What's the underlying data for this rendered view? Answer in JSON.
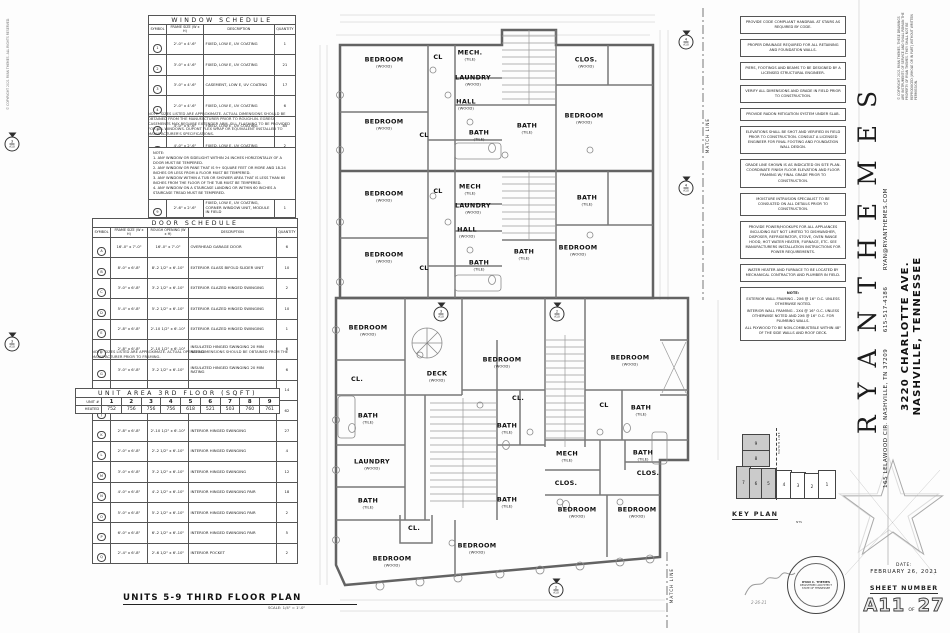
{
  "page": {
    "plan_title": "UNITS 5-9 THIRD FLOOR PLAN",
    "plan_scale": "SCALE: 1/4\" = 1'-0\"",
    "margin_note": "© COPYRIGHT 2021 RYAN THEMES. ALL RIGHTS RESERVED."
  },
  "window_schedule": {
    "title": "WINDOW SCHEDULE",
    "headers": [
      "SYMBOL",
      "FRAME SIZE (W x H)",
      "DESCRIPTION",
      "QUANTITY"
    ],
    "rows": [
      {
        "sym": "1",
        "size": "2'-0\" x 4'-6\"",
        "desc": "FIXED, LOW E, UV COATING",
        "qty": "1"
      },
      {
        "sym": "2",
        "size": "3'-0\" x 4'-6\"",
        "desc": "FIXED, LOW E, UV COATING",
        "qty": "21"
      },
      {
        "sym": "3",
        "size": "3'-0\" x 4'-6\"",
        "desc": "CASEMENT, LOW E, UV COATING",
        "qty": "17"
      },
      {
        "sym": "4",
        "size": "2'-0\" x 4'-6\"",
        "desc": "FIXED, LOW E, UV COATING",
        "qty": "6"
      },
      {
        "sym": "5",
        "size": "4'-0\" x 4'-6\"",
        "desc": "FIXED, LOW E, UV COATING",
        "qty": "85"
      },
      {
        "sym": "6",
        "size": "4'-0\" x 2'-6\"",
        "desc": "FIXED, LOW E, UV COATING",
        "qty": "2"
      },
      {
        "sym": "7",
        "size": "2'-0\" x 2'-0\"",
        "desc": "FIXED, LOW E, UV COATING",
        "qty": "7"
      },
      {
        "sym": "8",
        "size": "2'-6\" x 4'-6\"",
        "desc": "FIXED, LOW E, UV COATING",
        "qty": "2"
      },
      {
        "sym": "9",
        "size": "2'-6\" x 2'-6\"",
        "desc": "FIXED, LOW E, UV COATING, CORNER WINDOW UNIT, MODULE IN FIELD",
        "qty": "1"
      },
      {
        "sym": "10",
        "size": "2'-6\" x 2'-6\"",
        "desc": "FIXED, LOW E, UV COATING, CORNER WINDOW UNIT, MODULE IN FIELD",
        "qty": "2"
      }
    ],
    "note": "NOTE: SIZES LISTED ARE APPROXIMATE. ACTUAL DIMENSIONS SHOULD BE OBTAINED FROM THE MANUFACTURER PRIOR TO ROUGH-IN. EGRESS CASEMENTS MAY REQUIRE EXTENDER ARM. SILL FLASHING TO BE PROVIDED FOR ALL WINDOWS. DUPONT FLEX WRAP OR EQUIVALENT INSTALLED TO MANUFACTURER'S SPECIFICATIONS."
  },
  "tempered_notes": {
    "title": "NOTE:",
    "items": [
      "1. ANY WINDOW OR SIDELIGHT WITHIN 24 INCHES HORIZONTALLY OF A DOOR MUST BE TEMPERED.",
      "2. ANY WINDOW OR PANE THAT IS 9+ SQUARE FEET OR MORE AND 18-24 INCHES OR LESS FROM A FLOOR MUST BE TEMPERED.",
      "3. ANY WINDOW WITHIN A TUB OR SHOWER AREA THAT IS LESS THAN 60 INCHES FROM THE FLOOR OF THE TUB MUST BE TEMPERED.",
      "4. ANY WINDOW ON A STAIRCASE LANDING OR WITHIN 60 INCHES A STAIRCASE TREAD MUST BE TEMPERED."
    ]
  },
  "door_schedule": {
    "title": "DOOR SCHEDULE",
    "headers": [
      "SYMBOL",
      "FRAME SIZE (W x H)",
      "ROUGH OPENING (W x H)",
      "DESCRIPTION",
      "QUANTITY"
    ],
    "rows": [
      {
        "sym": "A",
        "frame": "16'-0\" x 7'-0\"",
        "rough": "16'-0\" x 7'-0\"",
        "desc": "OVERHEAD GARAGE DOOR",
        "qty": "6"
      },
      {
        "sym": "B",
        "frame": "8'-0\" x 6'-8\"",
        "rough": "8'-2 1/2\" x 6'-10\"",
        "desc": "EXTERIOR GLASS BIFOLD SLIDER UNIT",
        "qty": "10"
      },
      {
        "sym": "C",
        "frame": "3'-0\" x 6'-8\"",
        "rough": "3'-2 1/2\" x 6'-10\"",
        "desc": "EXTERIOR GLAZED HINGED SWINGING",
        "qty": "2"
      },
      {
        "sym": "D",
        "frame": "5'-4\" x 6'-8\"",
        "rough": "5'-2 1/2\" x 6'-10\"",
        "desc": "EXTERIOR GLAZED HINGED SWINGING",
        "qty": "10"
      },
      {
        "sym": "E",
        "frame": "2'-8\" x 6'-8\"",
        "rough": "2'-10 1/2\" x 6'-10\"",
        "desc": "EXTERIOR GLAZED HINGED SWINGING",
        "qty": "1"
      },
      {
        "sym": "F",
        "frame": "2'-8\" x 6'-8\"",
        "rough": "2'-10 1/2\" x 6'-10\"",
        "desc": "INSULATED HINGED SWINGING 20 MIN RATING",
        "qty": "6"
      },
      {
        "sym": "G",
        "frame": "3'-0\" x 6'-8\"",
        "rough": "3'-2 1/2\" x 6'-10\"",
        "desc": "INSULATED HINGED SWINGING 20 MIN RATING",
        "qty": "6"
      },
      {
        "sym": "H",
        "frame": "2'-8\" x 6'-8\"",
        "rough": "2'-10 1/2\" x 6'-10\"",
        "desc": "INTERIOR HINGED SWINGING",
        "qty": "14"
      },
      {
        "sym": "J",
        "frame": "2'-4\" x 6'-8\"",
        "rough": "2'-6 1/2\" x 6'-10\"",
        "desc": "INTERIOR HINGED SWINGING",
        "qty": "62"
      },
      {
        "sym": "K",
        "frame": "2'-8\" x 6'-8\"",
        "rough": "2'-10 1/2\" x 6'-10\"",
        "desc": "INTERIOR HINGED SWINGING",
        "qty": "27"
      },
      {
        "sym": "L",
        "frame": "2'-0\" x 6'-8\"",
        "rough": "2'-2 1/2\" x 6'-10\"",
        "desc": "INTERIOR HINGED SWINGING",
        "qty": "4"
      },
      {
        "sym": "M",
        "frame": "3'-0\" x 6'-8\"",
        "rough": "3'-2 1/2\" x 6'-10\"",
        "desc": "INTERIOR HINGED SWINGING",
        "qty": "12"
      },
      {
        "sym": "N",
        "frame": "4'-0\" x 6'-8\"",
        "rough": "4'-2 1/2\" x 6'-10\"",
        "desc": "INTERIOR HINGED SWINGING PAIR",
        "qty": "18"
      },
      {
        "sym": "O",
        "frame": "5'-0\" x 6'-8\"",
        "rough": "5'-2 1/2\" x 6'-10\"",
        "desc": "INTERIOR HINGED SWINGING PAIR",
        "qty": "2"
      },
      {
        "sym": "P",
        "frame": "6'-0\" x 6'-8\"",
        "rough": "6'-2 1/2\" x 6'-10\"",
        "desc": "INTERIOR HINGED SWINGING PAIR",
        "qty": "5"
      },
      {
        "sym": "Q",
        "frame": "2'-4\" x 6'-8\"",
        "rough": "2'-6 1/2\" x 6'-10\"",
        "desc": "INTERIOR POCKET",
        "qty": "2"
      }
    ],
    "note": "NOTE: SIZES LISTED ARE APPROXIMATE. ACTUAL OPENING DIMENSIONS SHOULD BE OBTAINED FROM THE MANUFACTURER PRIOR TO FRAMING."
  },
  "unit_area": {
    "title": "UNIT AREA 3RD FLOOR (SQFT)",
    "row_label_units": "UNIT #",
    "row_label_values": "HEATED",
    "columns": [
      "1",
      "2",
      "3",
      "4",
      "5",
      "6",
      "7",
      "8",
      "9"
    ],
    "values": [
      "752",
      "756",
      "756",
      "756",
      "618",
      "521",
      "503",
      "760",
      "761"
    ]
  },
  "site_notes": [
    "PROVIDE CODE COMPLIANT HANDRAIL AT STAIRS AS REQUIRED BY CODE.",
    "PROPER DRAINAGE REQUIRED FOR ALL RETAINING AND FOUNDATION WALLS.",
    "PIERS, FOOTINGS AND BEAMS TO BE DESIGNED BY A LICENSED STRUCTURAL ENGINEER.",
    "VERIFY ALL DIMENSIONS AND GRADE IN FIELD PRIOR TO CONSTRUCTION.",
    "PROVIDE RADON MITIGATION SYSTEM UNDER SLAB.",
    "ELEVATIONS SHALL BE SHOT AND VERIFIED IN FIELD PRIOR TO CONSTRUCTION. CONSULT A LICENSED ENGINEER FOR FINAL FOOTING AND FOUNDATION WALL DESIGN.",
    "GRADE LINE SHOWN IS AS INDICATED ON SITE PLAN. COORDINATE FINISH FLOOR ELEVATION AND FLOOR FRAMING W/ FINAL GRADE PRIOR TO CONSTRUCTION.",
    "MOISTURE INTRUSION SPECIALIST TO BE CONSULTED ON ALL DETAILS PRIOR TO CONSTRUCTION.",
    "PROVIDE POWER/HOOKUPS FOR ALL APPLIANCES INCLUDING BUT NOT LIMITED TO DISHWASHER, DISPOSER, REFRIGERATOR, STOVE, OVEN RANGE HOOD, HOT WATER HEATER, FURNACE, ETC. SEE MANUFACTURERS INSTALLATION INSTRUCTIONS FOR POWER REQUIREMENTS.",
    "WATER HEATER AND FURNACE TO BE LOCATED BY MECHANICAL CONTRACTOR AND PLUMBER IN FIELD."
  ],
  "framing_note": {
    "title": "NOTE:",
    "lines": [
      "EXTERIOR WALL FRAMING - 2X6 @ 16\" O.C. UNLESS OTHERWISE NOTED.",
      "INTERIOR WALL FRAMING - 2X4 @ 16\" O.C. UNLESS OTHERWISE NOTED AND 2X6 @ 16\" O.C. FOR PLUMBING WALLS.",
      "ALL PLYWOOD TO BE NON-COMBUSTIBLE WITHIN 48\" OF THE SIDE WALLS AND ROOF DECK."
    ]
  },
  "rooms": [
    {
      "label": "BEDROOM",
      "sub": "(WOOD)",
      "x": 384,
      "y": 62
    },
    {
      "label": "CL",
      "sub": "",
      "x": 438,
      "y": 57
    },
    {
      "label": "MECH.",
      "sub": "(TILE)",
      "x": 470,
      "y": 55
    },
    {
      "label": "LAUNDRY",
      "sub": "(WOOD)",
      "x": 473,
      "y": 80
    },
    {
      "label": "HALL",
      "sub": "(WOOD)",
      "x": 466,
      "y": 104
    },
    {
      "label": "BEDROOM",
      "sub": "(WOOD)",
      "x": 384,
      "y": 124
    },
    {
      "label": "CL",
      "sub": "",
      "x": 424,
      "y": 135
    },
    {
      "label": "BATH",
      "sub": "(TILE)",
      "x": 479,
      "y": 135
    },
    {
      "label": "BATH",
      "sub": "(TILE)",
      "x": 527,
      "y": 128
    },
    {
      "label": "CLOS.",
      "sub": "(WOOD)",
      "x": 586,
      "y": 62
    },
    {
      "label": "BEDROOM",
      "sub": "(WOOD)",
      "x": 584,
      "y": 118
    },
    {
      "label": "BEDROOM",
      "sub": "(WOOD)",
      "x": 384,
      "y": 196
    },
    {
      "label": "CL",
      "sub": "",
      "x": 438,
      "y": 191
    },
    {
      "label": "MECH",
      "sub": "(TILE)",
      "x": 470,
      "y": 189
    },
    {
      "label": "LAUNDRY",
      "sub": "(WOOD)",
      "x": 473,
      "y": 208
    },
    {
      "label": "HALL",
      "sub": "(WOOD)",
      "x": 467,
      "y": 232
    },
    {
      "label": "BEDROOM",
      "sub": "(WOOD)",
      "x": 384,
      "y": 257
    },
    {
      "label": "CL",
      "sub": "",
      "x": 424,
      "y": 268
    },
    {
      "label": "BATH",
      "sub": "(TILE)",
      "x": 479,
      "y": 265
    },
    {
      "label": "BATH",
      "sub": "(TILE)",
      "x": 524,
      "y": 254
    },
    {
      "label": "BATH",
      "sub": "(TILE)",
      "x": 587,
      "y": 200
    },
    {
      "label": "BEDROOM",
      "sub": "(WOOD)",
      "x": 578,
      "y": 250
    },
    {
      "label": "BEDROOM",
      "sub": "(WOOD)",
      "x": 368,
      "y": 330
    },
    {
      "label": "CL.",
      "sub": "",
      "x": 357,
      "y": 379
    },
    {
      "label": "BATH",
      "sub": "(TILE)",
      "x": 368,
      "y": 418
    },
    {
      "label": "LAUNDRY",
      "sub": "(WOOD)",
      "x": 372,
      "y": 464
    },
    {
      "label": "BATH",
      "sub": "(TILE)",
      "x": 368,
      "y": 503
    },
    {
      "label": "CL.",
      "sub": "",
      "x": 414,
      "y": 528
    },
    {
      "label": "BEDROOM",
      "sub": "(WOOD)",
      "x": 392,
      "y": 561
    },
    {
      "label": "DECK",
      "sub": "(WOOD)",
      "x": 437,
      "y": 376
    },
    {
      "label": "BEDROOM",
      "sub": "(WOOD)",
      "x": 502,
      "y": 362
    },
    {
      "label": "CL.",
      "sub": "",
      "x": 518,
      "y": 398
    },
    {
      "label": "BATH",
      "sub": "(TILE)",
      "x": 507,
      "y": 428
    },
    {
      "label": "BATH",
      "sub": "(TILE)",
      "x": 507,
      "y": 502
    },
    {
      "label": "BEDROOM",
      "sub": "(WOOD)",
      "x": 477,
      "y": 548
    },
    {
      "label": "BEDROOM",
      "sub": "(WOOD)",
      "x": 630,
      "y": 360
    },
    {
      "label": "CL",
      "sub": "",
      "x": 604,
      "y": 405
    },
    {
      "label": "BATH",
      "sub": "(TILE)",
      "x": 641,
      "y": 410
    },
    {
      "label": "MECH",
      "sub": "(TILE)",
      "x": 567,
      "y": 456
    },
    {
      "label": "CLOS.",
      "sub": "",
      "x": 566,
      "y": 483
    },
    {
      "label": "BATH",
      "sub": "(TILE)",
      "x": 643,
      "y": 455
    },
    {
      "label": "CLOS.",
      "sub": "",
      "x": 648,
      "y": 473
    },
    {
      "label": "BEDROOM",
      "sub": "(WOOD)",
      "x": 577,
      "y": 512
    },
    {
      "label": "BEDROOM",
      "sub": "(WOOD)",
      "x": 637,
      "y": 512
    }
  ],
  "markers": [
    {
      "num": "4",
      "sheet": "A10",
      "x": 686,
      "y": 40
    },
    {
      "num": "4",
      "sheet": "A10",
      "x": 686,
      "y": 186
    },
    {
      "num": "3",
      "sheet": "A10",
      "x": 441,
      "y": 312
    },
    {
      "num": "2",
      "sheet": "A10",
      "x": 557,
      "y": 312
    },
    {
      "num": "2",
      "sheet": "A10",
      "x": 556,
      "y": 588
    },
    {
      "num": "3",
      "sheet": "A10",
      "x": 12,
      "y": 142
    },
    {
      "num": "3",
      "sheet": "A10",
      "x": 12,
      "y": 342
    }
  ],
  "match_lines": {
    "upper": "MATCH LINE",
    "lower": "MATCH LINE"
  },
  "title_block": {
    "brand": "RYANTHEMES",
    "address": "165 LELAWOOD CIR.  NASHVILLE, TN 37209",
    "phone": "615-517-4186",
    "email": "RYAN@RYANTHEMES.COM",
    "project_line1": "3220 CHARLOTTE AVE.",
    "project_line2": "NASHVILLE, TENNESSEE",
    "copyright": "© COPYRIGHT 2021 RYAN THEMES. THESE DRAWINGS ARE INSTRUMENTS OF SERVICE AND SHALL REMAIN THE PROPERTY OF RYAN THEMES. THEY SHALL NOT BE REPRODUCED (WHOLE OR IN PART) WITHOUT WRITTEN PERMISSION.",
    "date_label": "DATE:",
    "date_value": "FEBRUARY 26, 2021",
    "sheet_label": "SHEET NUMBER",
    "sheet_number": "A11",
    "sheet_of": "OF",
    "sheet_total": "27"
  },
  "key_plan": {
    "label": "KEY PLAN",
    "scale": "NTS",
    "match_line": "MATCH LINE",
    "units": [
      {
        "n": "9",
        "x": 12,
        "y": 6,
        "w": 26,
        "h": 16,
        "shaded": true
      },
      {
        "n": "8",
        "x": 12,
        "y": 22,
        "w": 26,
        "h": 15,
        "shaded": true
      },
      {
        "n": "7",
        "x": 6,
        "y": 38,
        "w": 13,
        "h": 31,
        "shaded": true
      },
      {
        "n": "6",
        "x": 19,
        "y": 40,
        "w": 12,
        "h": 29,
        "shaded": true
      },
      {
        "n": "5",
        "x": 31,
        "y": 40,
        "w": 13,
        "h": 29,
        "shaded": true
      },
      {
        "n": "4",
        "x": 46,
        "y": 42,
        "w": 14,
        "h": 27,
        "shaded": false
      },
      {
        "n": "3",
        "x": 60,
        "y": 44,
        "w": 14,
        "h": 25,
        "shaded": false
      },
      {
        "n": "2",
        "x": 74,
        "y": 45,
        "w": 14,
        "h": 24,
        "shaded": false
      },
      {
        "n": "1",
        "x": 88,
        "y": 42,
        "w": 16,
        "h": 27,
        "shaded": false
      }
    ]
  },
  "seal": {
    "line1": "RYAN C. THEMES",
    "line2": "REGISTERED ARCHITECT",
    "line3": "STATE OF TENNESSEE",
    "sig_date": "2-26-21"
  }
}
